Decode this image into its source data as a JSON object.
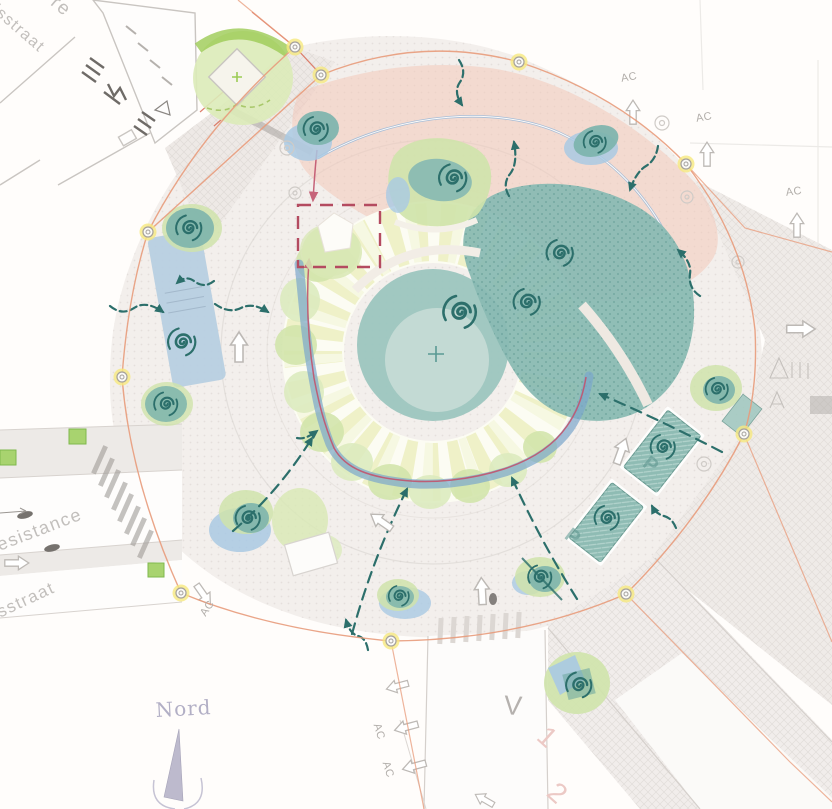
{
  "labels": {
    "street_top_partial": "re",
    "street_top": "dsstraat",
    "street_left_upper": "esistance",
    "street_left_lower": "sstraat",
    "compass_north": "Nord",
    "access_marker": "AC",
    "road_marking_v": "V",
    "parking_marker": "P",
    "lane_number_1": "1",
    "lane_number_2": "2"
  },
  "colors": {
    "plaza": "#f3efec",
    "pink-zone": "#f3c8ba",
    "teal-dark": "#2c6f6b",
    "teal-canopy": "#7db4ac",
    "green-canopy": "#cfe3ab",
    "pond-blue": "#a9c9e3",
    "canal-blue": "#b6cee1",
    "stream-blue": "#7aa6cc",
    "accent-red": "#c2556e",
    "square-red": "#b44b60",
    "boundary-orange": "#e89b7b",
    "node-yellow": "#f6e87f",
    "compass-purple": "#b2afc5",
    "street-text": "#c2bfbc"
  }
}
